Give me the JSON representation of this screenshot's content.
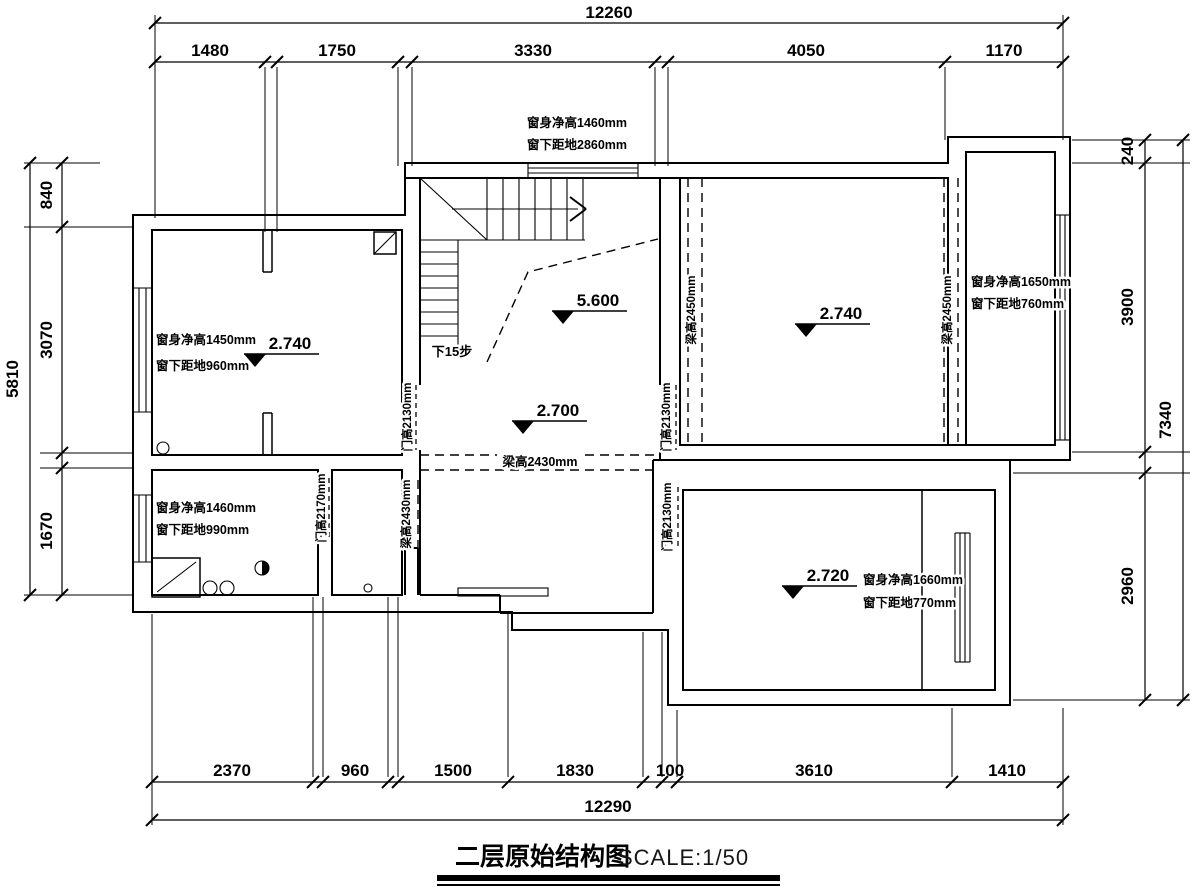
{
  "drawing": {
    "title": "二层原始结构图",
    "scale": "SCALE:1/50"
  },
  "dimensions": {
    "top": {
      "total": "12260",
      "segments": [
        "1480",
        "1750",
        "3330",
        "4050",
        "1170"
      ]
    },
    "bottom": {
      "total": "12290",
      "segments": [
        "2370",
        "960",
        "1500",
        "1830",
        "100",
        "3610",
        "1410"
      ]
    },
    "left": {
      "total": "5810",
      "segments": [
        "840",
        "3070",
        "1670"
      ]
    },
    "right": {
      "total": "7340",
      "segments": [
        "240",
        "3900",
        "2960"
      ]
    }
  },
  "elevation_markers": {
    "left_room": "2.740",
    "stairwell": "5.600",
    "hall": "2.700",
    "right_room": "2.740",
    "bottom_right_room": "2.720"
  },
  "window_labels": {
    "top": [
      "窗身净高1460mm",
      "窗下距地2860mm"
    ],
    "left_room": [
      "窗身净高1450mm",
      "窗下距地960mm"
    ],
    "bathroom": [
      "窗身净高1460mm",
      "窗下距地990mm"
    ],
    "right_room": [
      "窗身净高1650mm",
      "窗下距地760mm"
    ],
    "bottom_right_room": [
      "窗身净高1660mm",
      "窗下距地770mm"
    ]
  },
  "beam_labels": {
    "hall": "梁高2430mm",
    "closet": "梁高2430mm",
    "right_room_left": "梁高2450mm",
    "right_room_right": "梁高2450mm"
  },
  "door_labels": {
    "hall_left": "门高2130mm",
    "hall_right": "门高2130mm",
    "bathroom": "门高2170mm",
    "bottom_right_room": "门高2130mm"
  },
  "stair_label": "下15步",
  "colors": {
    "line": "#000000",
    "background": "#ffffff"
  }
}
